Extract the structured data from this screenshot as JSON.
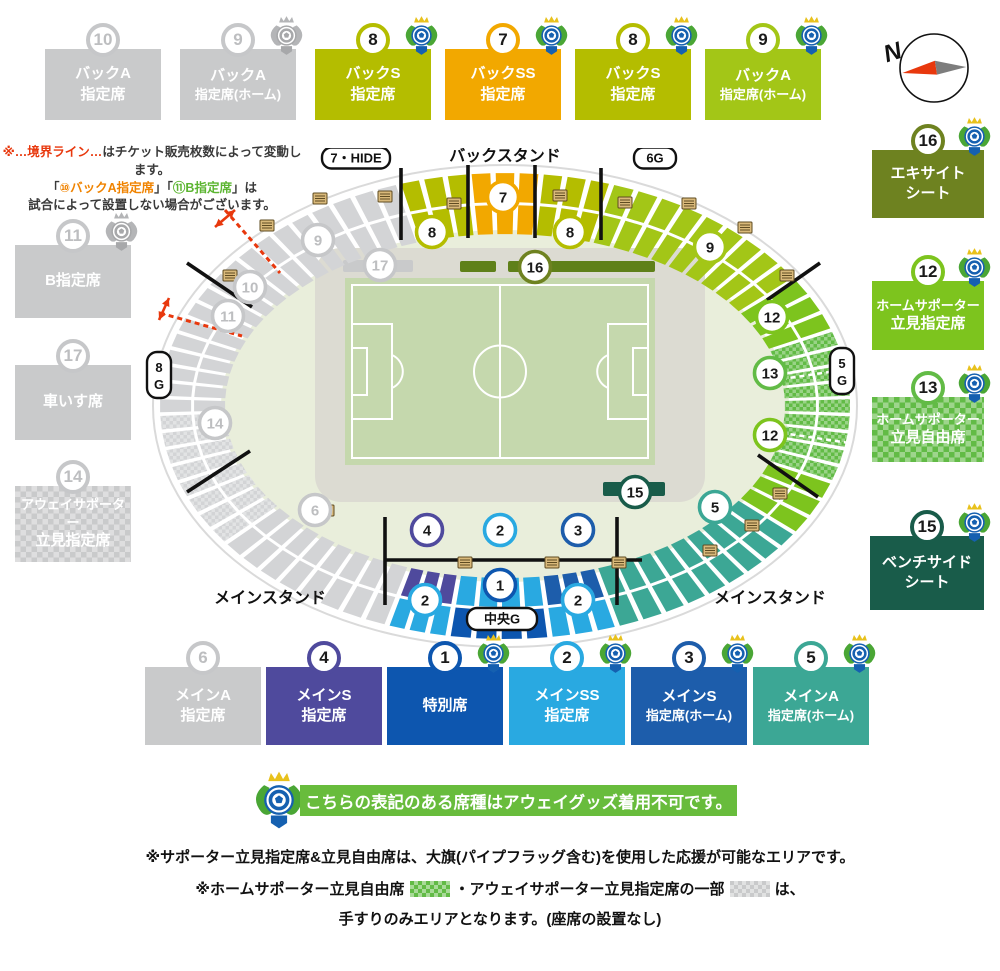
{
  "colors": {
    "gray": "#c9cacb",
    "blockGray": "#d3d4d6",
    "grayNum": "#bdbec0",
    "backS": "#b4bd00",
    "backSS": "#f2a800",
    "backAHome": "#a3c617",
    "excite": "#6e8220",
    "standRes": "#7dc41e",
    "standFree": "#62bb46",
    "bench": "#195c4a",
    "mainAHome": "#3ca795",
    "mainSHome": "#1d5dab",
    "mainSS": "#29a9e1",
    "mainS": "#4f4a9d",
    "tokubetsu": "#0d56af",
    "red": "#e8380d",
    "noteOrange": "#f08300",
    "noteGreen": "#5cb531",
    "dark": "#3a3a3a",
    "trackGreen": "#e9eedb",
    "pitchGreen": "#c5d8ad",
    "infieldGray": "#dcdbd2",
    "stripGreen": "#5f8019"
  },
  "legend": {
    "top": [
      {
        "n": "10",
        "x": 45,
        "y": 23,
        "w": 116,
        "h": 97,
        "color": "gray",
        "lines": [
          "バックA",
          "指定席"
        ]
      },
      {
        "n": "9",
        "x": 180,
        "y": 23,
        "w": 116,
        "h": 97,
        "color": "gray",
        "lines": [
          "バックA",
          "指定席(ホーム)"
        ],
        "logo": "gray"
      },
      {
        "n": "8",
        "x": 315,
        "y": 23,
        "w": 116,
        "h": 97,
        "color": "backS",
        "lines": [
          "バックS",
          "指定席"
        ],
        "logo": "color"
      },
      {
        "n": "7",
        "x": 445,
        "y": 23,
        "w": 116,
        "h": 97,
        "color": "backSS",
        "lines": [
          "バックSS",
          "指定席"
        ],
        "logo": "color"
      },
      {
        "n": "8",
        "x": 575,
        "y": 23,
        "w": 116,
        "h": 97,
        "color": "backS",
        "lines": [
          "バックS",
          "指定席"
        ],
        "logo": "color"
      },
      {
        "n": "9",
        "x": 705,
        "y": 23,
        "w": 116,
        "h": 97,
        "color": "backAHome",
        "lines": [
          "バックA",
          "指定席(ホーム)"
        ],
        "logo": "color"
      }
    ],
    "left": [
      {
        "n": "11",
        "x": 15,
        "y": 219,
        "w": 116,
        "h": 99,
        "color": "gray",
        "lines": [
          "B指定席"
        ],
        "logo": "gray"
      },
      {
        "n": "17",
        "x": 15,
        "y": 339,
        "w": 116,
        "h": 101,
        "color": "gray",
        "lines": [
          "車いす席"
        ]
      },
      {
        "n": "14",
        "x": 15,
        "y": 460,
        "w": 116,
        "h": 102,
        "color": "gray",
        "checker": true,
        "lines": [
          "アウェイサポーター",
          "立見指定席"
        ]
      }
    ],
    "right": [
      {
        "n": "16",
        "x": 872,
        "y": 124,
        "w": 112,
        "h": 94,
        "color": "excite",
        "lines": [
          "エキサイト",
          "シート"
        ],
        "logo": "color"
      },
      {
        "n": "12",
        "x": 872,
        "y": 255,
        "w": 112,
        "h": 95,
        "color": "standRes",
        "lines": [
          "ホームサポーター",
          "立見指定席"
        ],
        "logo": "color"
      },
      {
        "n": "13",
        "x": 872,
        "y": 371,
        "w": 112,
        "h": 91,
        "color": "standFree",
        "checker": true,
        "lines": [
          "ホームサポーター",
          "立見自由席"
        ],
        "logo": "color"
      },
      {
        "n": "15",
        "x": 870,
        "y": 510,
        "w": 114,
        "h": 100,
        "color": "bench",
        "lines": [
          "ベンチサイド",
          "シート"
        ],
        "logo": "color"
      }
    ],
    "bottom": [
      {
        "n": "6",
        "x": 145,
        "y": 641,
        "w": 116,
        "h": 104,
        "color": "gray",
        "lines": [
          "メインA",
          "指定席"
        ]
      },
      {
        "n": "4",
        "x": 266,
        "y": 641,
        "w": 116,
        "h": 104,
        "color": "mainS",
        "lines": [
          "メインS",
          "指定席"
        ]
      },
      {
        "n": "1",
        "x": 387,
        "y": 641,
        "w": 116,
        "h": 104,
        "color": "tokubetsu",
        "lines": [
          "特別席"
        ],
        "logo": "color"
      },
      {
        "n": "2",
        "x": 509,
        "y": 641,
        "w": 116,
        "h": 104,
        "color": "mainSS",
        "lines": [
          "メインSS",
          "指定席"
        ],
        "logo": "color"
      },
      {
        "n": "3",
        "x": 631,
        "y": 641,
        "w": 116,
        "h": 104,
        "color": "mainSHome",
        "lines": [
          "メインS",
          "指定席(ホーム)"
        ],
        "logo": "color"
      },
      {
        "n": "5",
        "x": 753,
        "y": 641,
        "w": 116,
        "h": 104,
        "color": "mainAHome",
        "lines": [
          "メインA",
          "指定席(ホーム)"
        ],
        "logo": "color"
      }
    ]
  },
  "notes_topleft": {
    "lines": [
      [
        {
          "t": "※…境界ライン…",
          "c": "red"
        },
        {
          "t": "はチケット販売枚数によって変動します。",
          "c": "dark"
        }
      ],
      [
        {
          "t": "「",
          "c": "dark"
        },
        {
          "t": "⑩バックA指定席",
          "c": "noteOrange"
        },
        {
          "t": "」「",
          "c": "dark"
        },
        {
          "t": "⑪B指定席",
          "c": "noteGreen"
        },
        {
          "t": "」は",
          "c": "dark"
        }
      ],
      [
        {
          "t": "試合によって設置しない場合がございます。",
          "c": "dark"
        }
      ]
    ]
  },
  "banner": {
    "text": "こちらの表記のある席種はアウェイグッズ着用不可です。"
  },
  "notes_bottom": {
    "line1": "※サポーター立見指定席&立見自由席は、大旗(パイプフラッグ含む)を使用した応援が可能なエリアです。",
    "line2_parts": [
      {
        "t": "※ホームサポーター立見自由席"
      },
      {
        "swatch": "standFree"
      },
      {
        "t": "・アウェイサポーター立見指定席の一部"
      },
      {
        "swatch": "gray"
      },
      {
        "t": "は、"
      }
    ],
    "line3": "手すりのみエリアとなります。(座席の設置なし)"
  },
  "compass": {
    "label": "N"
  },
  "stadium": {
    "stand_labels": [
      {
        "t": "バックスタンド",
        "x": 360,
        "y": 13
      },
      {
        "t": "メインスタンド",
        "x": 125,
        "y": 455
      },
      {
        "t": "メインスタンド",
        "x": 625,
        "y": 455
      }
    ],
    "gates": [
      {
        "t": "7・HIDE",
        "x": 211,
        "y": 10,
        "w": 68,
        "h": 21
      },
      {
        "t": "6G",
        "x": 510,
        "y": 10,
        "w": 42,
        "h": 21
      },
      {
        "t": "中央G",
        "x": 357,
        "y": 471,
        "w": 70,
        "h": 22
      },
      {
        "t": "8G",
        "x": 14,
        "y": 227,
        "w": 24,
        "h": 46,
        "v": true
      },
      {
        "t": "5G",
        "x": 697,
        "y": 223,
        "w": 24,
        "h": 46,
        "v": true
      }
    ],
    "sections": [
      {
        "s": -18,
        "e": -6,
        "c": "backS"
      },
      {
        "s": -6,
        "e": 6,
        "c": "backSS"
      },
      {
        "s": 6,
        "e": 18,
        "c": "backS"
      },
      {
        "s": 18,
        "e": 57,
        "c": "backAHome"
      },
      {
        "s": 57,
        "e": 71,
        "c": "standRes"
      },
      {
        "s": 71,
        "e": 109,
        "c": "standFree",
        "checker": true
      },
      {
        "s": 109,
        "e": 123,
        "c": "standRes"
      },
      {
        "s": 123,
        "e": 161,
        "c": "mainAHome"
      },
      {
        "s": 161,
        "e": 172.5,
        "ci": "mainSHome",
        "co": "mainSS"
      },
      {
        "s": 172.5,
        "e": 189.5,
        "ci": "mainSS",
        "co": "tokubetsu"
      },
      {
        "s": 189.5,
        "e": 200,
        "ci": "mainS",
        "co": "mainSS"
      },
      {
        "s": 200,
        "e": 234,
        "c": "gray"
      },
      {
        "s": 234,
        "e": 268,
        "c": "gray",
        "checker": true
      },
      {
        "s": 268,
        "e": 342,
        "c": "gray"
      }
    ],
    "white_dashes": [
      81,
      99
    ],
    "strips": [
      {
        "x": 198,
        "y": 112,
        "w": 70,
        "h": 12,
        "c": "gray"
      },
      {
        "x": 315,
        "y": 113,
        "w": 36,
        "h": 11,
        "c": "stripGreen"
      },
      {
        "x": 363,
        "y": 113,
        "w": 147,
        "h": 11,
        "c": "stripGreen"
      },
      {
        "x": 458,
        "y": 334,
        "w": 62,
        "h": 14,
        "c": "bench"
      }
    ],
    "lines": [
      [
        256,
        20,
        256,
        92
      ],
      [
        323,
        17,
        323,
        90
      ],
      [
        390,
        17,
        390,
        90
      ],
      [
        456,
        20,
        456,
        92
      ],
      [
        42,
        115,
        107,
        159
      ],
      [
        622,
        152,
        675,
        115
      ],
      [
        613,
        307,
        673,
        349
      ],
      [
        42,
        344,
        105,
        303
      ],
      [
        240,
        369,
        240,
        457
      ],
      [
        472,
        369,
        472,
        457
      ],
      [
        240,
        412,
        497,
        412
      ]
    ],
    "dashed": [
      [
        80,
        62,
        135,
        125
      ],
      [
        15,
        165,
        97,
        188
      ]
    ],
    "arrows": [
      [
        70,
        79,
        90,
        62
      ],
      [
        14,
        172,
        24,
        150
      ]
    ],
    "stairs": [
      [
        115,
        72
      ],
      [
        78,
        122
      ],
      [
        168,
        45
      ],
      [
        233,
        43
      ],
      [
        302,
        50
      ],
      [
        408,
        42
      ],
      [
        473,
        49
      ],
      [
        537,
        50
      ],
      [
        593,
        74
      ],
      [
        635,
        122
      ],
      [
        628,
        340
      ],
      [
        600,
        372
      ],
      [
        558,
        397
      ],
      [
        313,
        409
      ],
      [
        400,
        409
      ],
      [
        467,
        409
      ],
      [
        175,
        357
      ]
    ],
    "markers": [
      {
        "n": "9",
        "x": 173,
        "y": 92,
        "c": "gray"
      },
      {
        "n": "10",
        "x": 105,
        "y": 139,
        "c": "gray"
      },
      {
        "n": "11",
        "x": 83,
        "y": 168,
        "c": "gray"
      },
      {
        "n": "17",
        "x": 235,
        "y": 117,
        "c": "gray"
      },
      {
        "n": "14",
        "x": 70,
        "y": 275,
        "c": "gray"
      },
      {
        "n": "6",
        "x": 170,
        "y": 362,
        "c": "gray"
      },
      {
        "n": "8",
        "x": 287,
        "y": 84,
        "c": "backS"
      },
      {
        "n": "7",
        "x": 358,
        "y": 49,
        "c": "backSS"
      },
      {
        "n": "8",
        "x": 425,
        "y": 84,
        "c": "backS"
      },
      {
        "n": "9",
        "x": 565,
        "y": 99,
        "c": "backAHome"
      },
      {
        "n": "16",
        "x": 390,
        "y": 119,
        "c": "excite"
      },
      {
        "n": "12",
        "x": 627,
        "y": 169,
        "c": "standRes"
      },
      {
        "n": "13",
        "x": 625,
        "y": 225,
        "c": "standFree"
      },
      {
        "n": "12",
        "x": 625,
        "y": 287,
        "c": "standRes"
      },
      {
        "n": "15",
        "x": 490,
        "y": 344,
        "c": "bench"
      },
      {
        "n": "5",
        "x": 570,
        "y": 359,
        "c": "mainAHome"
      },
      {
        "n": "4",
        "x": 282,
        "y": 382,
        "c": "mainS"
      },
      {
        "n": "2",
        "x": 355,
        "y": 382,
        "c": "mainSS"
      },
      {
        "n": "3",
        "x": 433,
        "y": 382,
        "c": "mainSHome"
      },
      {
        "n": "2",
        "x": 280,
        "y": 452,
        "c": "mainSS"
      },
      {
        "n": "1",
        "x": 355,
        "y": 437,
        "c": "tokubetsu"
      },
      {
        "n": "2",
        "x": 433,
        "y": 452,
        "c": "mainSS"
      }
    ]
  }
}
